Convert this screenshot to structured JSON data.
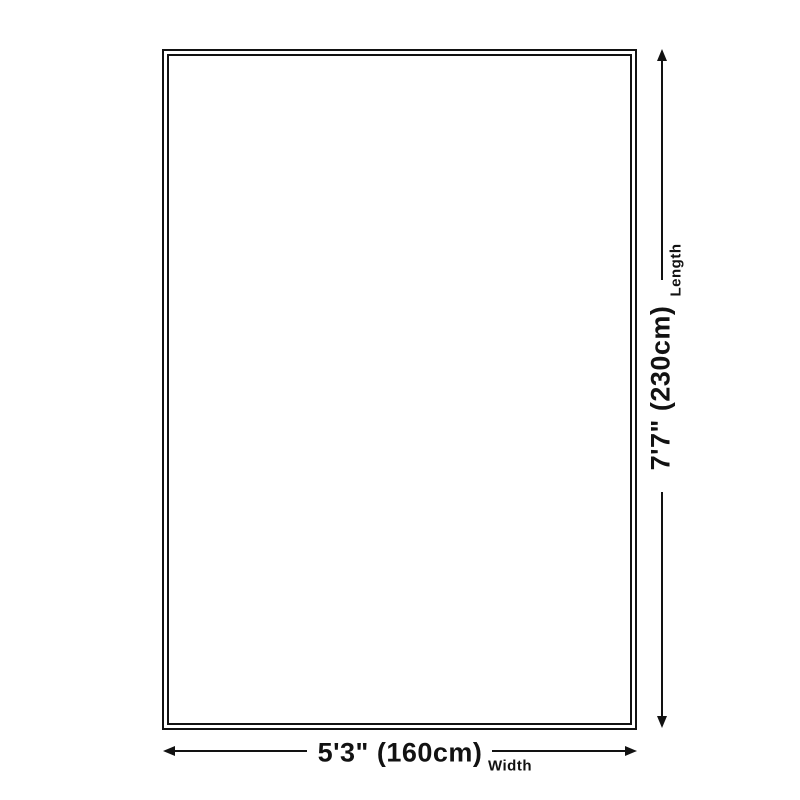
{
  "colors": {
    "background": "#ffffff",
    "line": "#121212",
    "text": "#121212"
  },
  "dimensions": {
    "length": {
      "label": "Length",
      "value": "7'7\" (230cm)"
    },
    "width": {
      "label": "Width",
      "value": "5'3\" (160cm)"
    }
  }
}
